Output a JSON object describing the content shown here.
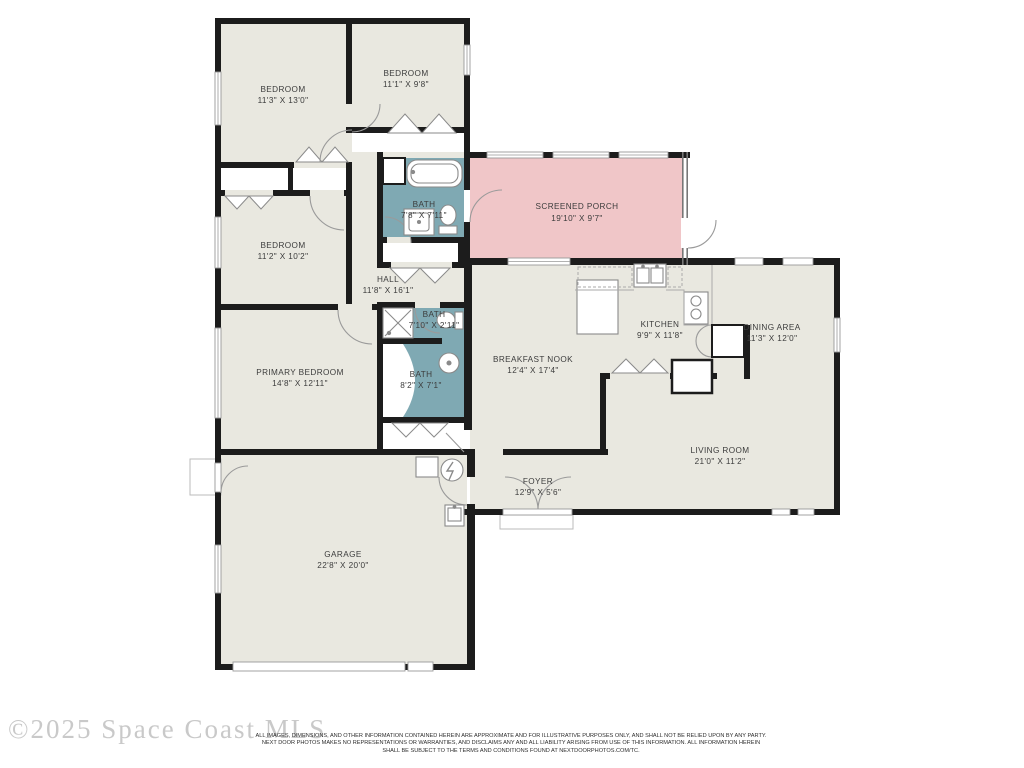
{
  "floorplan": {
    "title": "Single-story house floor plan",
    "colors": {
      "wall": "#1c1c1c",
      "floor": "#e9e8e0",
      "bath": "#7fa9b3",
      "porch": "#f0c6c8",
      "fixture_stroke": "#8a8a8a"
    },
    "rooms": [
      {
        "name": "BEDROOM",
        "dims": "11'3\" X 13'0\""
      },
      {
        "name": "BEDROOM",
        "dims": "11'1\" X 9'8\""
      },
      {
        "name": "BATH",
        "dims": "7'8\" X 7'11\""
      },
      {
        "name": "SCREENED PORCH",
        "dims": "19'10\" X 9'7\""
      },
      {
        "name": "BEDROOM",
        "dims": "11'2\" X 10'2\""
      },
      {
        "name": "HALL",
        "dims": "11'8\" X 16'1\""
      },
      {
        "name": "BATH",
        "dims": "7'10\" X 2'11\""
      },
      {
        "name": "BATH",
        "dims": "8'2\" X 7'1\""
      },
      {
        "name": "PRIMARY BEDROOM",
        "dims": "14'8\" X 12'11\""
      },
      {
        "name": "BREAKFAST NOOK",
        "dims": "12'4\" X 17'4\""
      },
      {
        "name": "KITCHEN",
        "dims": "9'9\" X 11'8\""
      },
      {
        "name": "DINING AREA",
        "dims": "11'3\" X 12'0\""
      },
      {
        "name": "LIVING ROOM",
        "dims": "21'0\" X 11'2\""
      },
      {
        "name": "FOYER",
        "dims": "12'9\" X 5'6\""
      },
      {
        "name": "GARAGE",
        "dims": "22'8\" X 20'0\""
      }
    ]
  },
  "footer": {
    "watermark": "©2025 Space Coast MLS",
    "disclaimer_line1": "ALL IMAGES, DIMENSIONS, AND OTHER INFORMATION CONTAINED HEREIN ARE APPROXIMATE AND FOR ILLUSTRATIVE PURPOSES ONLY, AND SHALL NOT BE RELIED UPON BY ANY PARTY.",
    "disclaimer_line2": "NEXT DOOR PHOTOS MAKES NO REPRESENTATIONS OR WARRANTIES, AND DISCLAIMS ANY AND ALL LIABILITY ARISING FROM USE OF THIS INFORMATION. ALL INFORMATION HEREIN",
    "disclaimer_line3": "SHALL BE SUBJECT TO THE TERMS AND CONDITIONS FOUND AT NEXTDOORPHOTOS.COM/TC."
  }
}
